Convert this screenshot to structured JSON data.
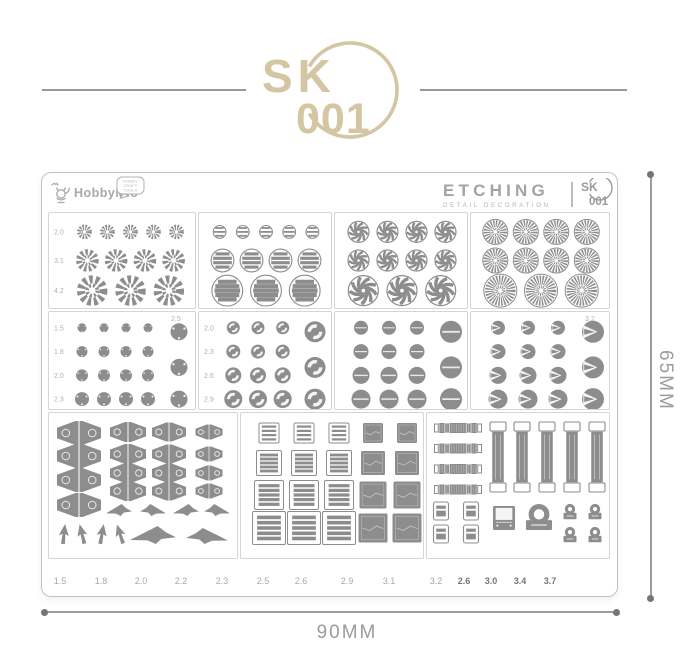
{
  "logo": {
    "sk": "SK",
    "num": "001"
  },
  "sheet": {
    "brand": {
      "name": "HobbyMio",
      "bubble": [
        "HOBBY",
        "CRAFT",
        "TOOLS"
      ]
    },
    "etching": {
      "title": "ETCHING",
      "subtitle": "DETAIL DECORATION",
      "badge_sk": "SK",
      "badge_num": "001"
    }
  },
  "panels": [
    {
      "name": "gear-rings",
      "kind": "rings",
      "shape": "gear",
      "rows": [
        {
          "label": "2.0",
          "count": 5,
          "d": 15
        },
        {
          "label": "3.1",
          "count": 4,
          "d": 23
        },
        {
          "label": "4.2",
          "count": 3,
          "d": 31
        }
      ]
    },
    {
      "name": "louver-discs",
      "kind": "rings",
      "shape": "louver",
      "rows": [
        {
          "count": 5,
          "d": 14
        },
        {
          "count": 4,
          "d": 24
        },
        {
          "count": 3,
          "d": 32
        }
      ]
    },
    {
      "name": "turbine-wheels",
      "kind": "rings",
      "shape": "turbine",
      "rows": [
        {
          "count": 4,
          "d": 22
        },
        {
          "count": 4,
          "d": 22
        },
        {
          "count": 3,
          "d": 31
        }
      ]
    },
    {
      "name": "fan-discs",
      "kind": "rings",
      "shape": "fan",
      "rows": [
        {
          "count": 4,
          "d": 26
        },
        {
          "count": 4,
          "d": 26
        },
        {
          "count": 3,
          "d": 34
        }
      ]
    },
    {
      "name": "rivet-dots",
      "kind": "rivets",
      "shape": "dot",
      "side": {
        "label": "2.5",
        "d": 17
      },
      "rows": [
        {
          "label": "1.5",
          "count": 4,
          "d": 9
        },
        {
          "label": "1.8",
          "count": 4,
          "d": 11
        },
        {
          "label": "2.0",
          "count": 4,
          "d": 12
        },
        {
          "label": "2.3",
          "count": 4,
          "d": 14
        }
      ]
    },
    {
      "name": "ring-rivets",
      "kind": "rivets",
      "shape": "ring",
      "side": {
        "d": 21
      },
      "rows": [
        {
          "label": "2.0",
          "count": 3,
          "d": 13
        },
        {
          "label": "2.3",
          "count": 3,
          "d": 14
        },
        {
          "label": "2.6",
          "count": 3,
          "d": 16
        },
        {
          "label": "2.9",
          "count": 3,
          "d": 18
        }
      ]
    },
    {
      "name": "slot-rivets",
      "kind": "rivets",
      "shape": "slot",
      "side": {
        "d": 22
      },
      "rows": [
        {
          "count": 3,
          "d": 14
        },
        {
          "count": 3,
          "d": 15
        },
        {
          "count": 3,
          "d": 17
        },
        {
          "count": 3,
          "d": 19
        }
      ]
    },
    {
      "name": "cone-ports",
      "kind": "rivets",
      "shape": "cone",
      "side": {
        "label": "3.2",
        "d": 22
      },
      "rows": [
        {
          "count": 3,
          "d": 14
        },
        {
          "count": 3,
          "d": 15
        },
        {
          "count": 3,
          "d": 17
        },
        {
          "count": 3,
          "d": 19
        }
      ]
    },
    {
      "name": "hinges-and-jets",
      "kind": "hinges",
      "hinge_columns": [
        {
          "count": 4,
          "w": 44,
          "h": 24
        },
        {
          "count": 4,
          "w": 36,
          "h": 20
        },
        {
          "count": 4,
          "w": 34,
          "h": 19
        },
        {
          "count": 4,
          "w": 27,
          "h": 15
        }
      ],
      "darts": 4,
      "small_jets": 4,
      "large_jets": 2
    },
    {
      "name": "vent-grilles",
      "kind": "vents",
      "rows": 4,
      "louver_columns": 3,
      "solid_columns": 2,
      "louver_sizes": [
        20,
        25,
        29,
        33
      ],
      "solid_sizes": [
        20,
        24,
        27,
        29
      ]
    },
    {
      "name": "straps-and-buckles",
      "kind": "straps",
      "h_straps": 4,
      "v_straps": 5,
      "buckles": 4,
      "plates": 1,
      "locks": 1,
      "clasps": 4
    }
  ],
  "bottom_sizes": {
    "light": [
      "1.5",
      "1.8",
      "2.0",
      "2.2",
      "2.3",
      "2.5",
      "2.6",
      "2.9",
      "3.1",
      "3.2"
    ],
    "dark": [
      "2.6",
      "3.0",
      "3.4",
      "3.7"
    ]
  },
  "dimensions": {
    "width_label": "90MM",
    "height_label": "65MM"
  },
  "colors": {
    "gold": "#d4c6a2",
    "part": "#8d8d8d",
    "panel_border": "#d5d5d5",
    "sheet_border": "#c2c2c2",
    "panel_label": "#b0b0b0",
    "size_light": "#a8a8a8",
    "size_dark": "#757575",
    "dim": "#9b9b9b",
    "dim_dot": "#757575",
    "brand": "#a8a8a8",
    "etch_title": "#a3a3a3",
    "etch_sub": "#b5b5b5",
    "badge": "#9a9a9a"
  }
}
